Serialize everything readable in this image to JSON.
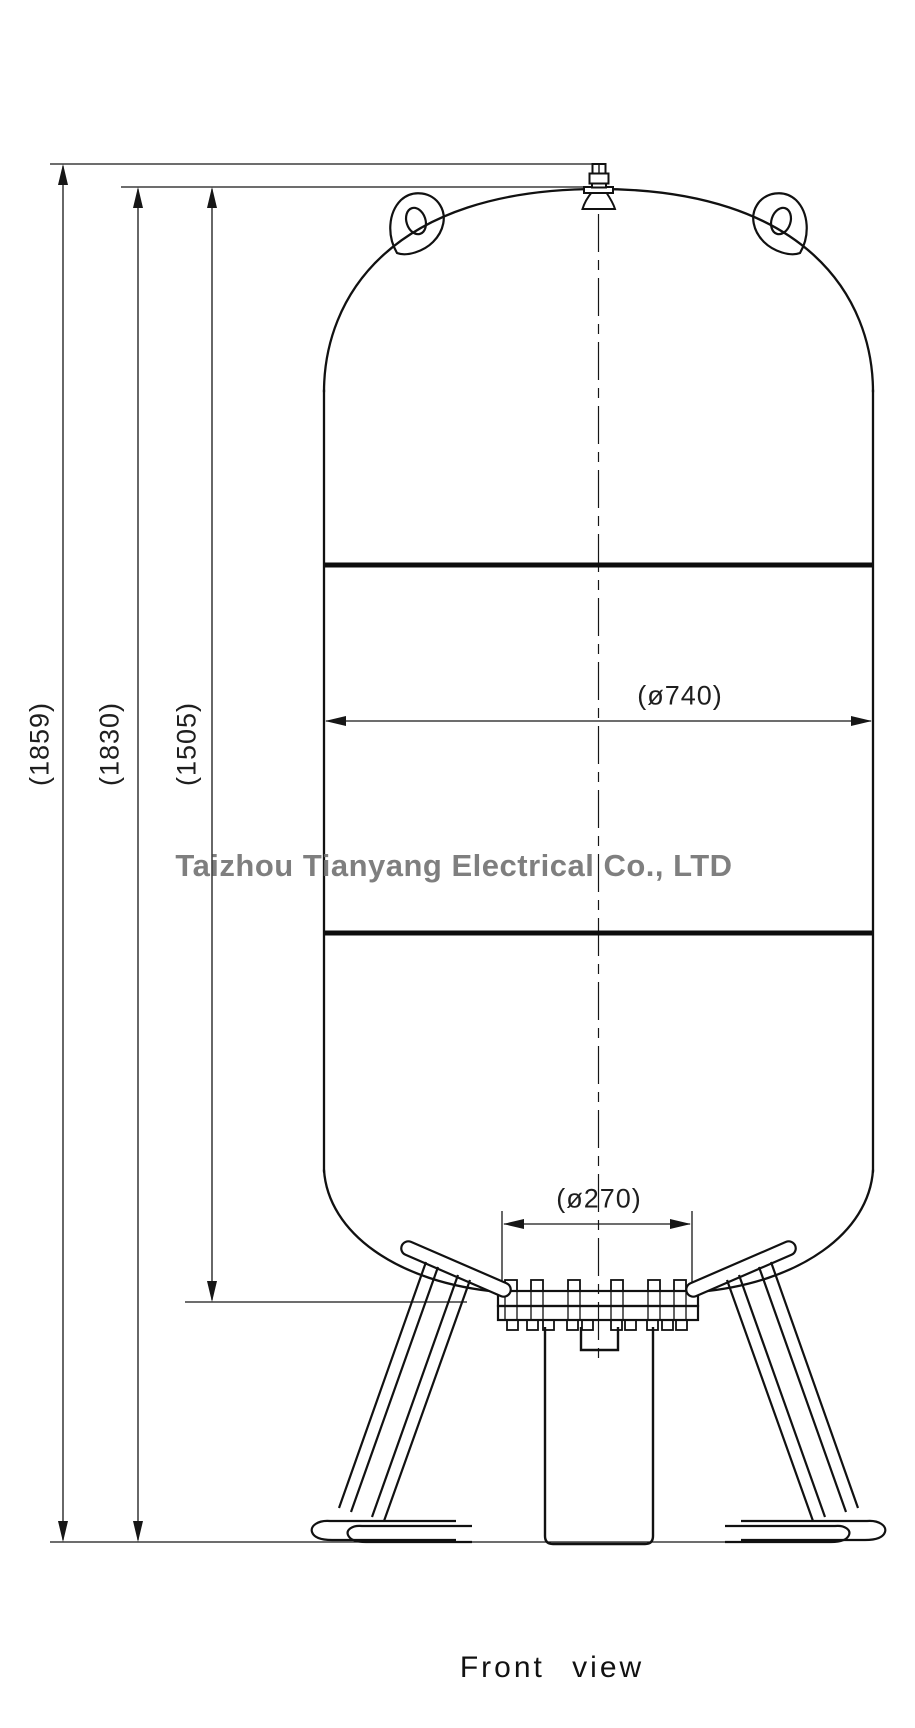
{
  "watermark": {
    "text": "Taizhou Tianyang Electrical Co., LTD",
    "color": "#6e6e6e"
  },
  "view_label": {
    "text": "Front view"
  },
  "dimensions": {
    "overall_height": {
      "label": "(1859)"
    },
    "vessel_height": {
      "label": "(1830)"
    },
    "shell_height": {
      "label": "(1505)"
    },
    "body_diameter": {
      "label": "(ø740)"
    },
    "base_diameter": {
      "label": "(ø270)"
    }
  },
  "line_color": "#161616"
}
